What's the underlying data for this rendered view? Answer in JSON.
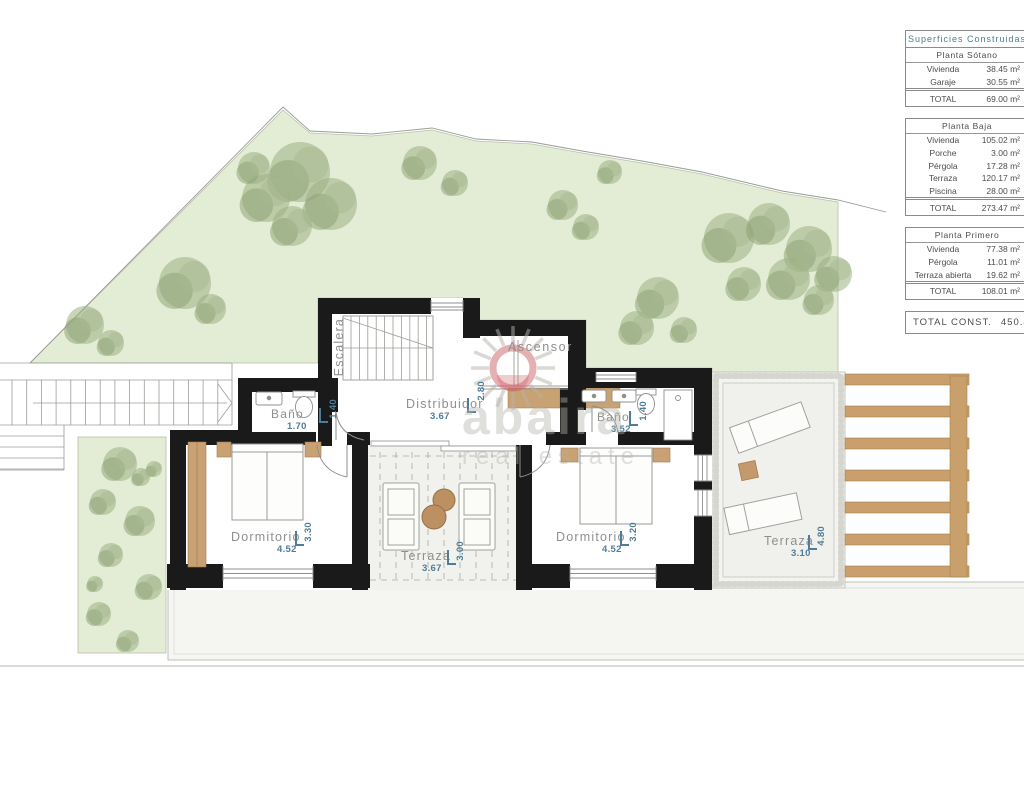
{
  "rooms": {
    "escalera": {
      "label": "Escalera"
    },
    "ascensor": {
      "label": "Ascensor"
    },
    "distribuidor": {
      "label": "Distribuidor",
      "w": "3.67",
      "h": "2.80"
    },
    "bano_left": {
      "label": "Baño",
      "w": "1.70",
      "h": "1.40"
    },
    "bano_right": {
      "label": "Baño",
      "w": "3.52",
      "h": "1.40"
    },
    "dorm_left": {
      "label": "Dormitorio",
      "w": "4.52",
      "h": "3.30"
    },
    "dorm_right": {
      "label": "Dormitorio",
      "w": "4.52",
      "h": "3.20"
    },
    "terraza_center": {
      "label": "Terraza",
      "w": "3.67",
      "h": "3.00"
    },
    "terraza_right": {
      "label": "Terraza",
      "w": "3.10",
      "h": "4.80"
    }
  },
  "title_block": {
    "header": "Superficies Construidas",
    "unit": "m²",
    "sections": [
      {
        "title": "Planta Sótano",
        "rows": [
          [
            "Vivienda",
            "38.45"
          ],
          [
            "Garaje",
            "30.55"
          ]
        ],
        "total": [
          "TOTAL",
          "69.00"
        ]
      },
      {
        "title": "Planta Baja",
        "rows": [
          [
            "Vivienda",
            "105.02"
          ],
          [
            "Porche",
            "3.00"
          ],
          [
            "Pérgola",
            "17.28"
          ],
          [
            "Terraza",
            "120.17"
          ],
          [
            "Piscina",
            "28.00"
          ]
        ],
        "total": [
          "TOTAL",
          "273.47"
        ]
      },
      {
        "title": "Planta Primero",
        "rows": [
          [
            "Vivienda",
            "77.38"
          ],
          [
            "Pérgola",
            "11.01"
          ],
          [
            "Terraza abierta",
            "19.62"
          ]
        ],
        "total": [
          "TOTAL",
          "108.01"
        ]
      }
    ],
    "grand_total_label": "TOTAL CONST.",
    "grand_total_value": "450.48"
  },
  "watermark": {
    "brand": "abaira",
    "tagline": "real estate"
  },
  "colors": {
    "garden_green": "#e3ecd4",
    "tree_green": "#9cb083",
    "wall_black": "#1a1a1a",
    "wood": "#c8a273",
    "dimension_blue": "#4f7d99",
    "label_gray": "#8f8f8f",
    "logo_pink": "#cd5f66"
  }
}
